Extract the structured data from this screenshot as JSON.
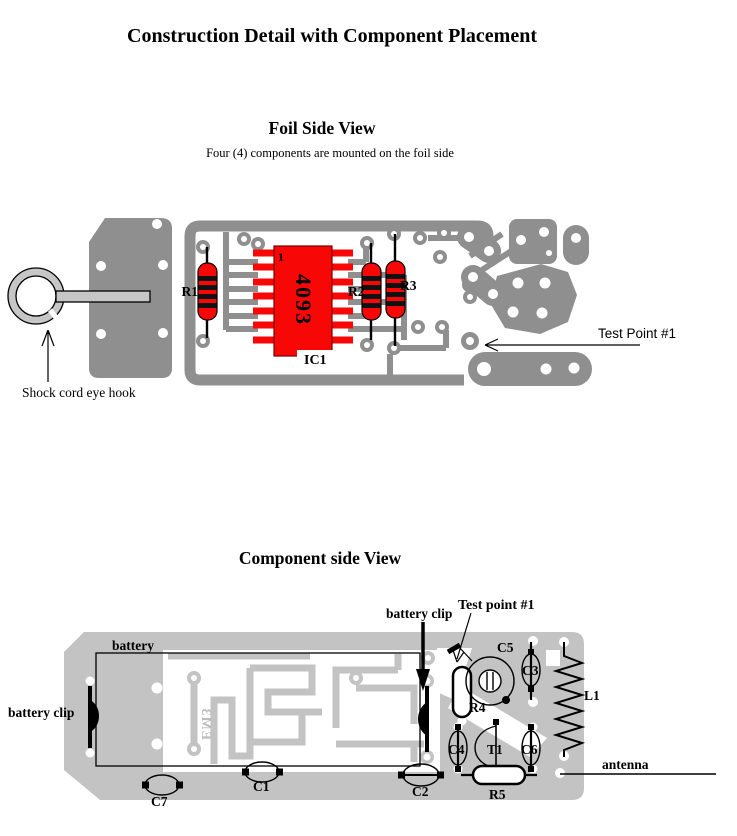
{
  "title": "Construction Detail with Component Placement",
  "foil_view": {
    "heading": "Foil Side View",
    "subheading": "Four (4) components are mounted on the foil side",
    "eye_hook_label": "Shock cord eye hook",
    "test_point_label": "Test Point #1",
    "components": {
      "r1": "R1",
      "r2": "R2",
      "r3": "R3",
      "ic_ref": "IC1",
      "ic_part": "4093",
      "ic_pin1": "1"
    }
  },
  "component_view": {
    "heading": "Component side View",
    "battery_label": "battery",
    "battery_clip_left_label": "battery clip",
    "battery_clip_top_label": "battery clip",
    "test_point_label": "Test point #1",
    "antenna_label": "antenna",
    "board_foil_text": "EM3",
    "components": {
      "c1": "C1",
      "c2": "C2",
      "c3": "C3",
      "c4": "C4",
      "c5": "C5",
      "c6": "C6",
      "c7": "C7",
      "r4": "R4",
      "r5": "R5",
      "t1": "T1",
      "l1": "L1"
    }
  },
  "colors": {
    "foil_copper": "#8f8f8f",
    "component_board": "#c3c3c3",
    "component_red": "#f80707",
    "hardware_gray": "#c6c6c6",
    "board_text_gray": "#bdbdbd"
  }
}
